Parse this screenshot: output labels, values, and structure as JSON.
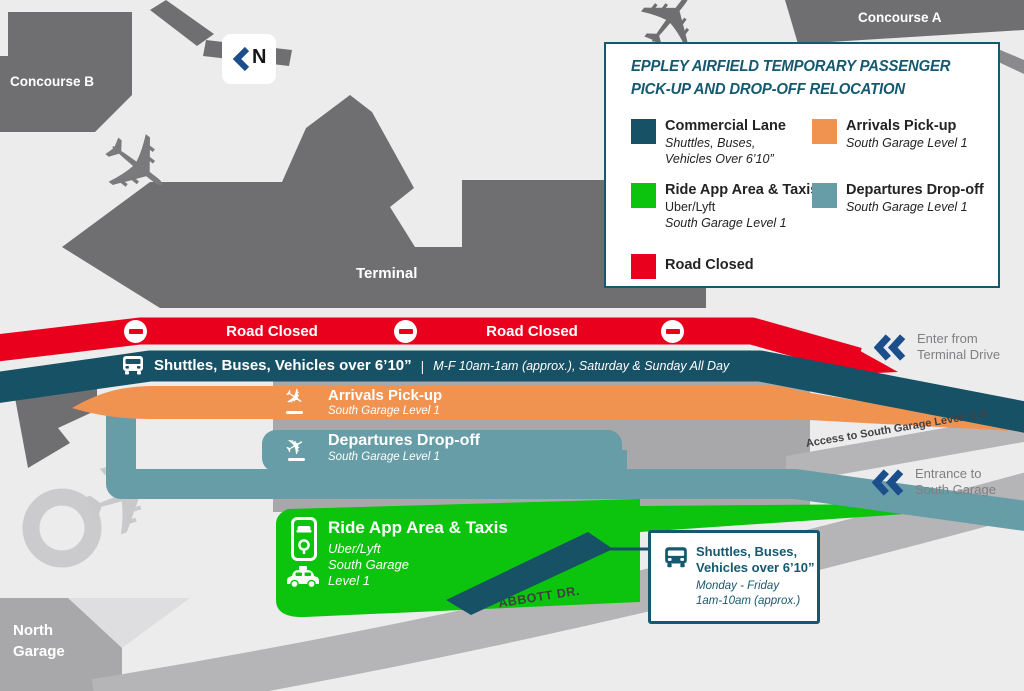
{
  "legend": {
    "title_line1": "EPPLEY AIRFIELD TEMPORARY PASSENGER",
    "title_line2": "PICK-UP AND DROP-OFF RELOCATION",
    "commercial": {
      "label": "Commercial Lane",
      "sub1": "Shuttles, Buses,",
      "sub2": "Vehicles Over 6’10”"
    },
    "arrivals": {
      "label": "Arrivals Pick-up",
      "sub1": "South Garage Level 1"
    },
    "rideapp": {
      "label": "Ride App Area & Taxis",
      "sub1": "Uber/Lyft",
      "sub2": "South Garage Level 1"
    },
    "departures": {
      "label": "Departures Drop-off",
      "sub1": "South Garage Level 1"
    },
    "road_closed": {
      "label": "Road Closed"
    }
  },
  "map": {
    "concourse_a": "Concourse A",
    "concourse_b": "Concourse B",
    "terminal": "Terminal",
    "north_garage_line1": "North",
    "north_garage_line2": "Garage",
    "abbott_dr": "ABBOTT DR.",
    "north_letter": "N"
  },
  "bands": {
    "road_closed_left": "Road Closed",
    "road_closed_right": "Road Closed",
    "commercial_main": "Shuttles, Buses, Vehicles over 6’10”",
    "commercial_divider": "|",
    "commercial_hours": "M-F 10am-1am (approx.), Saturday & Sunday All Day",
    "arrivals_title": "Arrivals Pick-up",
    "arrivals_sub": "South Garage Level 1",
    "departures_title": "Departures Drop-off",
    "departures_sub": "South Garage Level 1",
    "rideapp_title": "Ride App Area & Taxis",
    "rideapp_sub1": "Uber/Lyft",
    "rideapp_sub2": "South Garage",
    "rideapp_sub3": "Level 1"
  },
  "annotations": {
    "enter_line1": "Enter from",
    "enter_line2": "Terminal Drive",
    "access_road": "Access to South Garage Levels 2-6",
    "entrance_line1": "Entrance to",
    "entrance_line2": "South Garage"
  },
  "callout": {
    "line1": "Shuttles, Buses,",
    "line2": "Vehicles over 6’10”",
    "line3": "Monday - Friday",
    "line4": "1am-10am (approx.)"
  },
  "colors": {
    "commercial": "#175166",
    "arrivals": "#f09351",
    "rideapp": "#0cc30e",
    "departures": "#679da6",
    "road_closed": "#e8001c",
    "chevron_blue": "#1d4e8c",
    "legend_teal": "#155970"
  }
}
